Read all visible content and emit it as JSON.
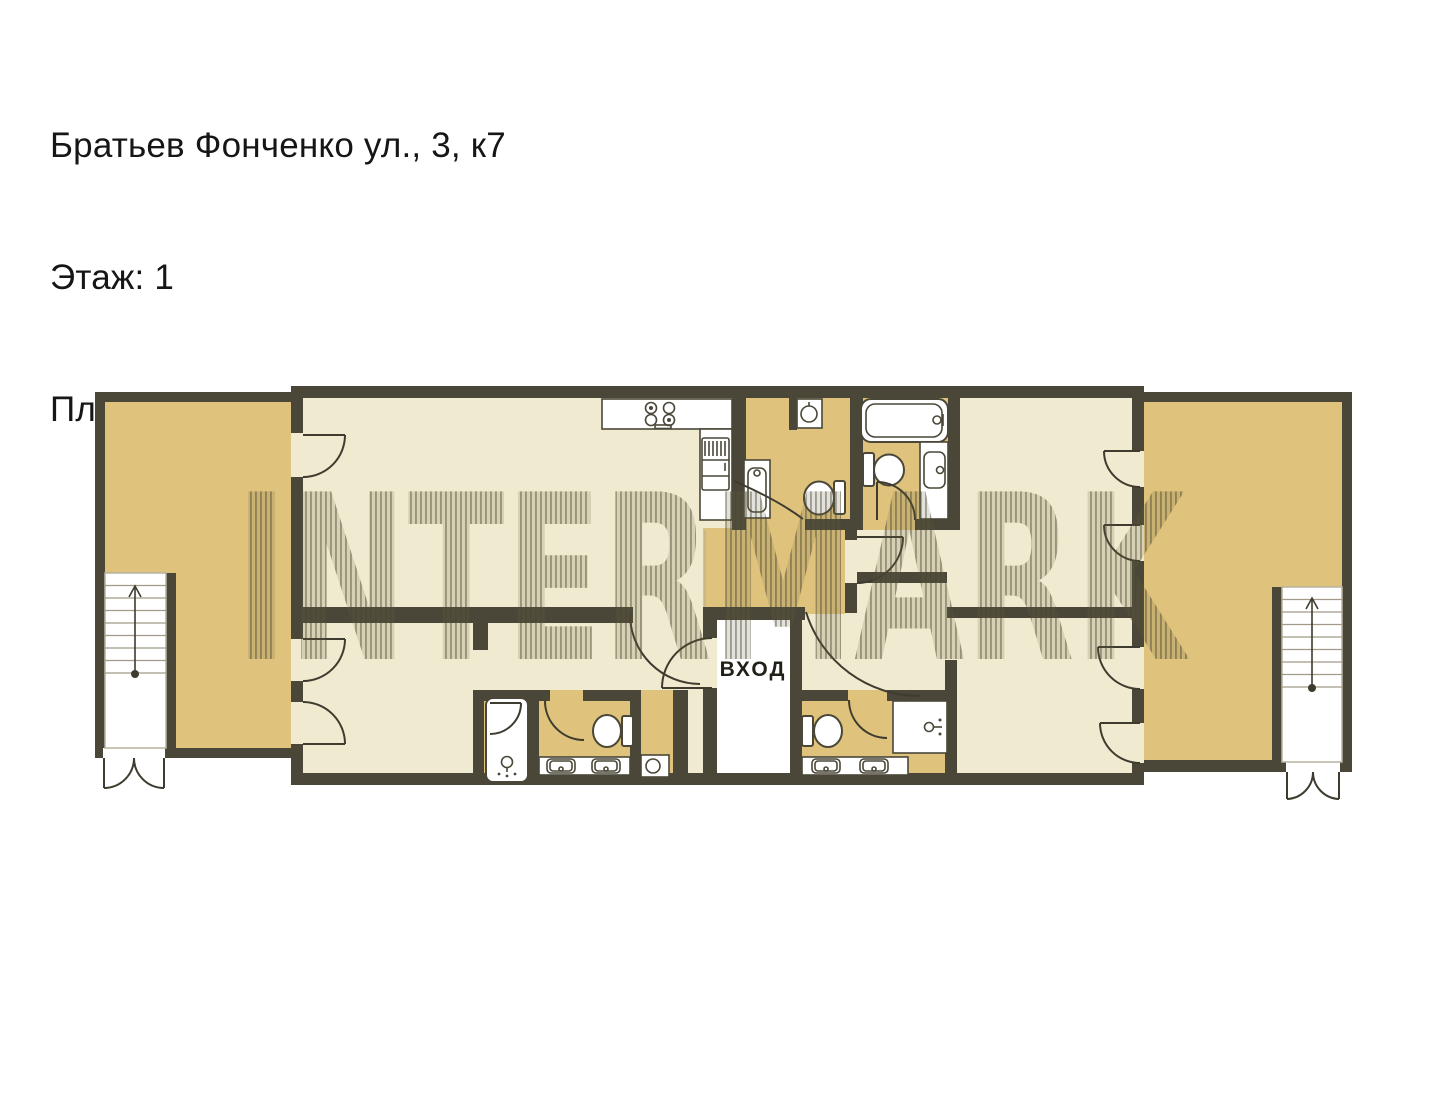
{
  "header": {
    "address_line": "Братьев Фонченко ул., 3, к7",
    "floor_line": "Этаж: 1",
    "area_line": "Площадь: 150,0 кв.м"
  },
  "floorplan": {
    "entrance_label": "ВХОД",
    "watermark_text": "INTERMARK",
    "colors": {
      "wall": "#4a4738",
      "room_fill": "#f0ebd0",
      "terrace_fill": "#dfc37c",
      "entrance_fill": "#ffffff",
      "watermark_stripe": "#55503a",
      "text": "#161616"
    },
    "rooms": [
      "left-terrace",
      "living-kitchen",
      "bathroom-top-small",
      "bathroom-top-large",
      "inner-hall",
      "entrance-hall",
      "bedroom-left",
      "bathroom-bottom-left",
      "bedroom-right-top",
      "bedroom-right-bottom",
      "bathroom-bottom-right",
      "right-terrace"
    ],
    "fixtures": [
      "kitchen-counter",
      "stove",
      "fridge",
      "sink",
      "toilet",
      "bathtub",
      "shower",
      "washing-machine",
      "double-vanity",
      "stairs",
      "double-exit-door"
    ]
  }
}
